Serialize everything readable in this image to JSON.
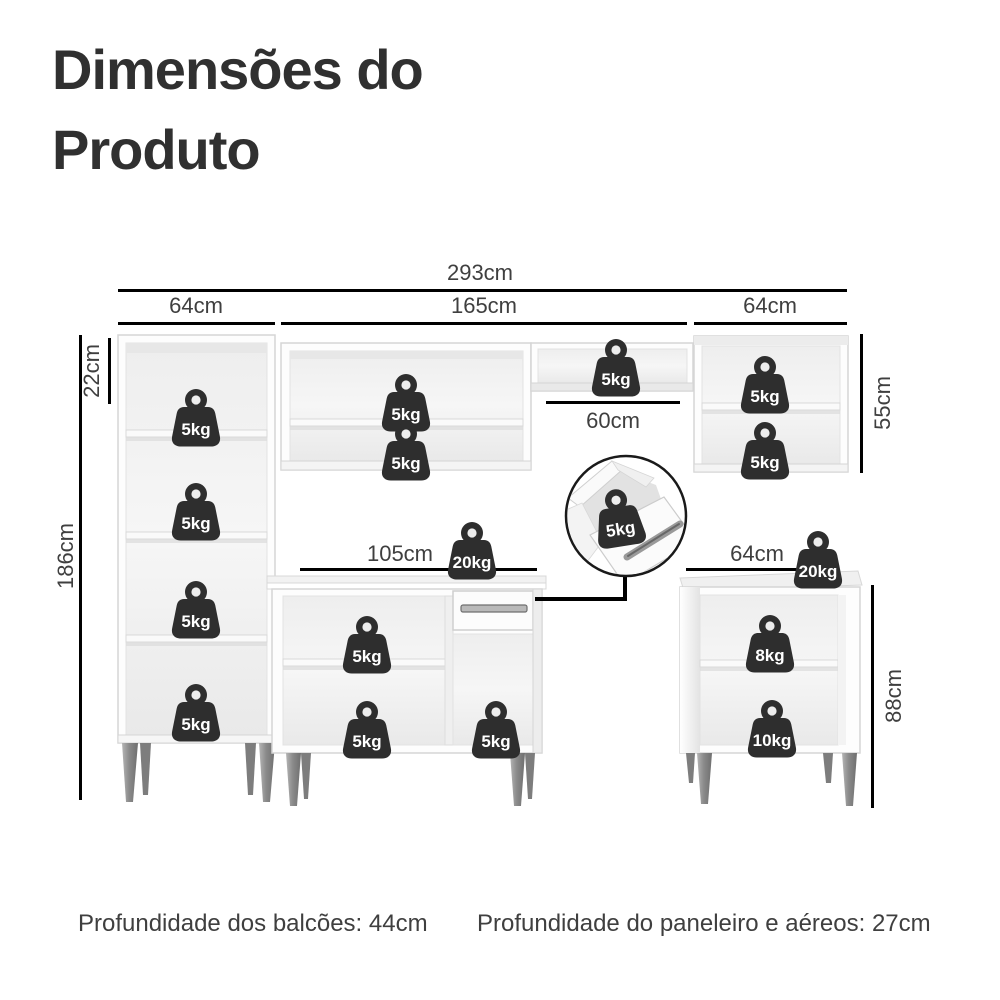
{
  "title": {
    "line1": "Dimensões do",
    "line2": "Produto"
  },
  "dimension_labels": {
    "total_width": "293cm",
    "paneleiro_width": "64cm",
    "aereo_middle_width": "165cm",
    "aereo_right_width": "64cm",
    "top_gap_height": "22cm",
    "paneleiro_height": "186cm",
    "aereo_right_height": "55cm",
    "niche_width": "60cm",
    "balcao_middle_width": "105cm",
    "balcao_right_width": "64cm",
    "balcao_right_height": "88cm"
  },
  "badges": [
    {
      "location": "paneleiro-shelf-1",
      "label": "5kg"
    },
    {
      "location": "paneleiro-shelf-2",
      "label": "5kg"
    },
    {
      "location": "paneleiro-shelf-3",
      "label": "5kg"
    },
    {
      "location": "paneleiro-shelf-4",
      "label": "5kg"
    },
    {
      "location": "aereo-middle-shelf-1",
      "label": "5kg"
    },
    {
      "location": "aereo-middle-shelf-2",
      "label": "5kg"
    },
    {
      "location": "aereo-bridge-shelf",
      "label": "5kg"
    },
    {
      "location": "aereo-right-shelf-1",
      "label": "5kg"
    },
    {
      "location": "aereo-right-shelf-2",
      "label": "5kg"
    },
    {
      "location": "drawer-detail",
      "label": "5kg"
    },
    {
      "location": "balcao-middle-countertop",
      "label": "20kg"
    },
    {
      "location": "balcao-middle-shelf-1",
      "label": "5kg"
    },
    {
      "location": "balcao-middle-shelf-2",
      "label": "5kg"
    },
    {
      "location": "balcao-middle-right-compartment",
      "label": "5kg"
    },
    {
      "location": "balcao-right-countertop",
      "label": "20kg"
    },
    {
      "location": "balcao-right-shelf-1",
      "label": "8kg"
    },
    {
      "location": "balcao-right-shelf-2",
      "label": "10kg"
    }
  ],
  "footer": {
    "balcoes_depth": "Profundidade dos balcões: 44cm",
    "paneleiro_depth": "Profundidade do paneleiro e aéreos: 27cm"
  },
  "colors": {
    "background": "#ffffff",
    "dimension_line": "#000000",
    "label_text": "#3f3f3f",
    "title_text": "#303030",
    "badge_bg": "#2e2e2e",
    "badge_text": "#ffffff",
    "furniture_edge": "#d5d5d5",
    "leg_gray": "#8f8f8f"
  }
}
